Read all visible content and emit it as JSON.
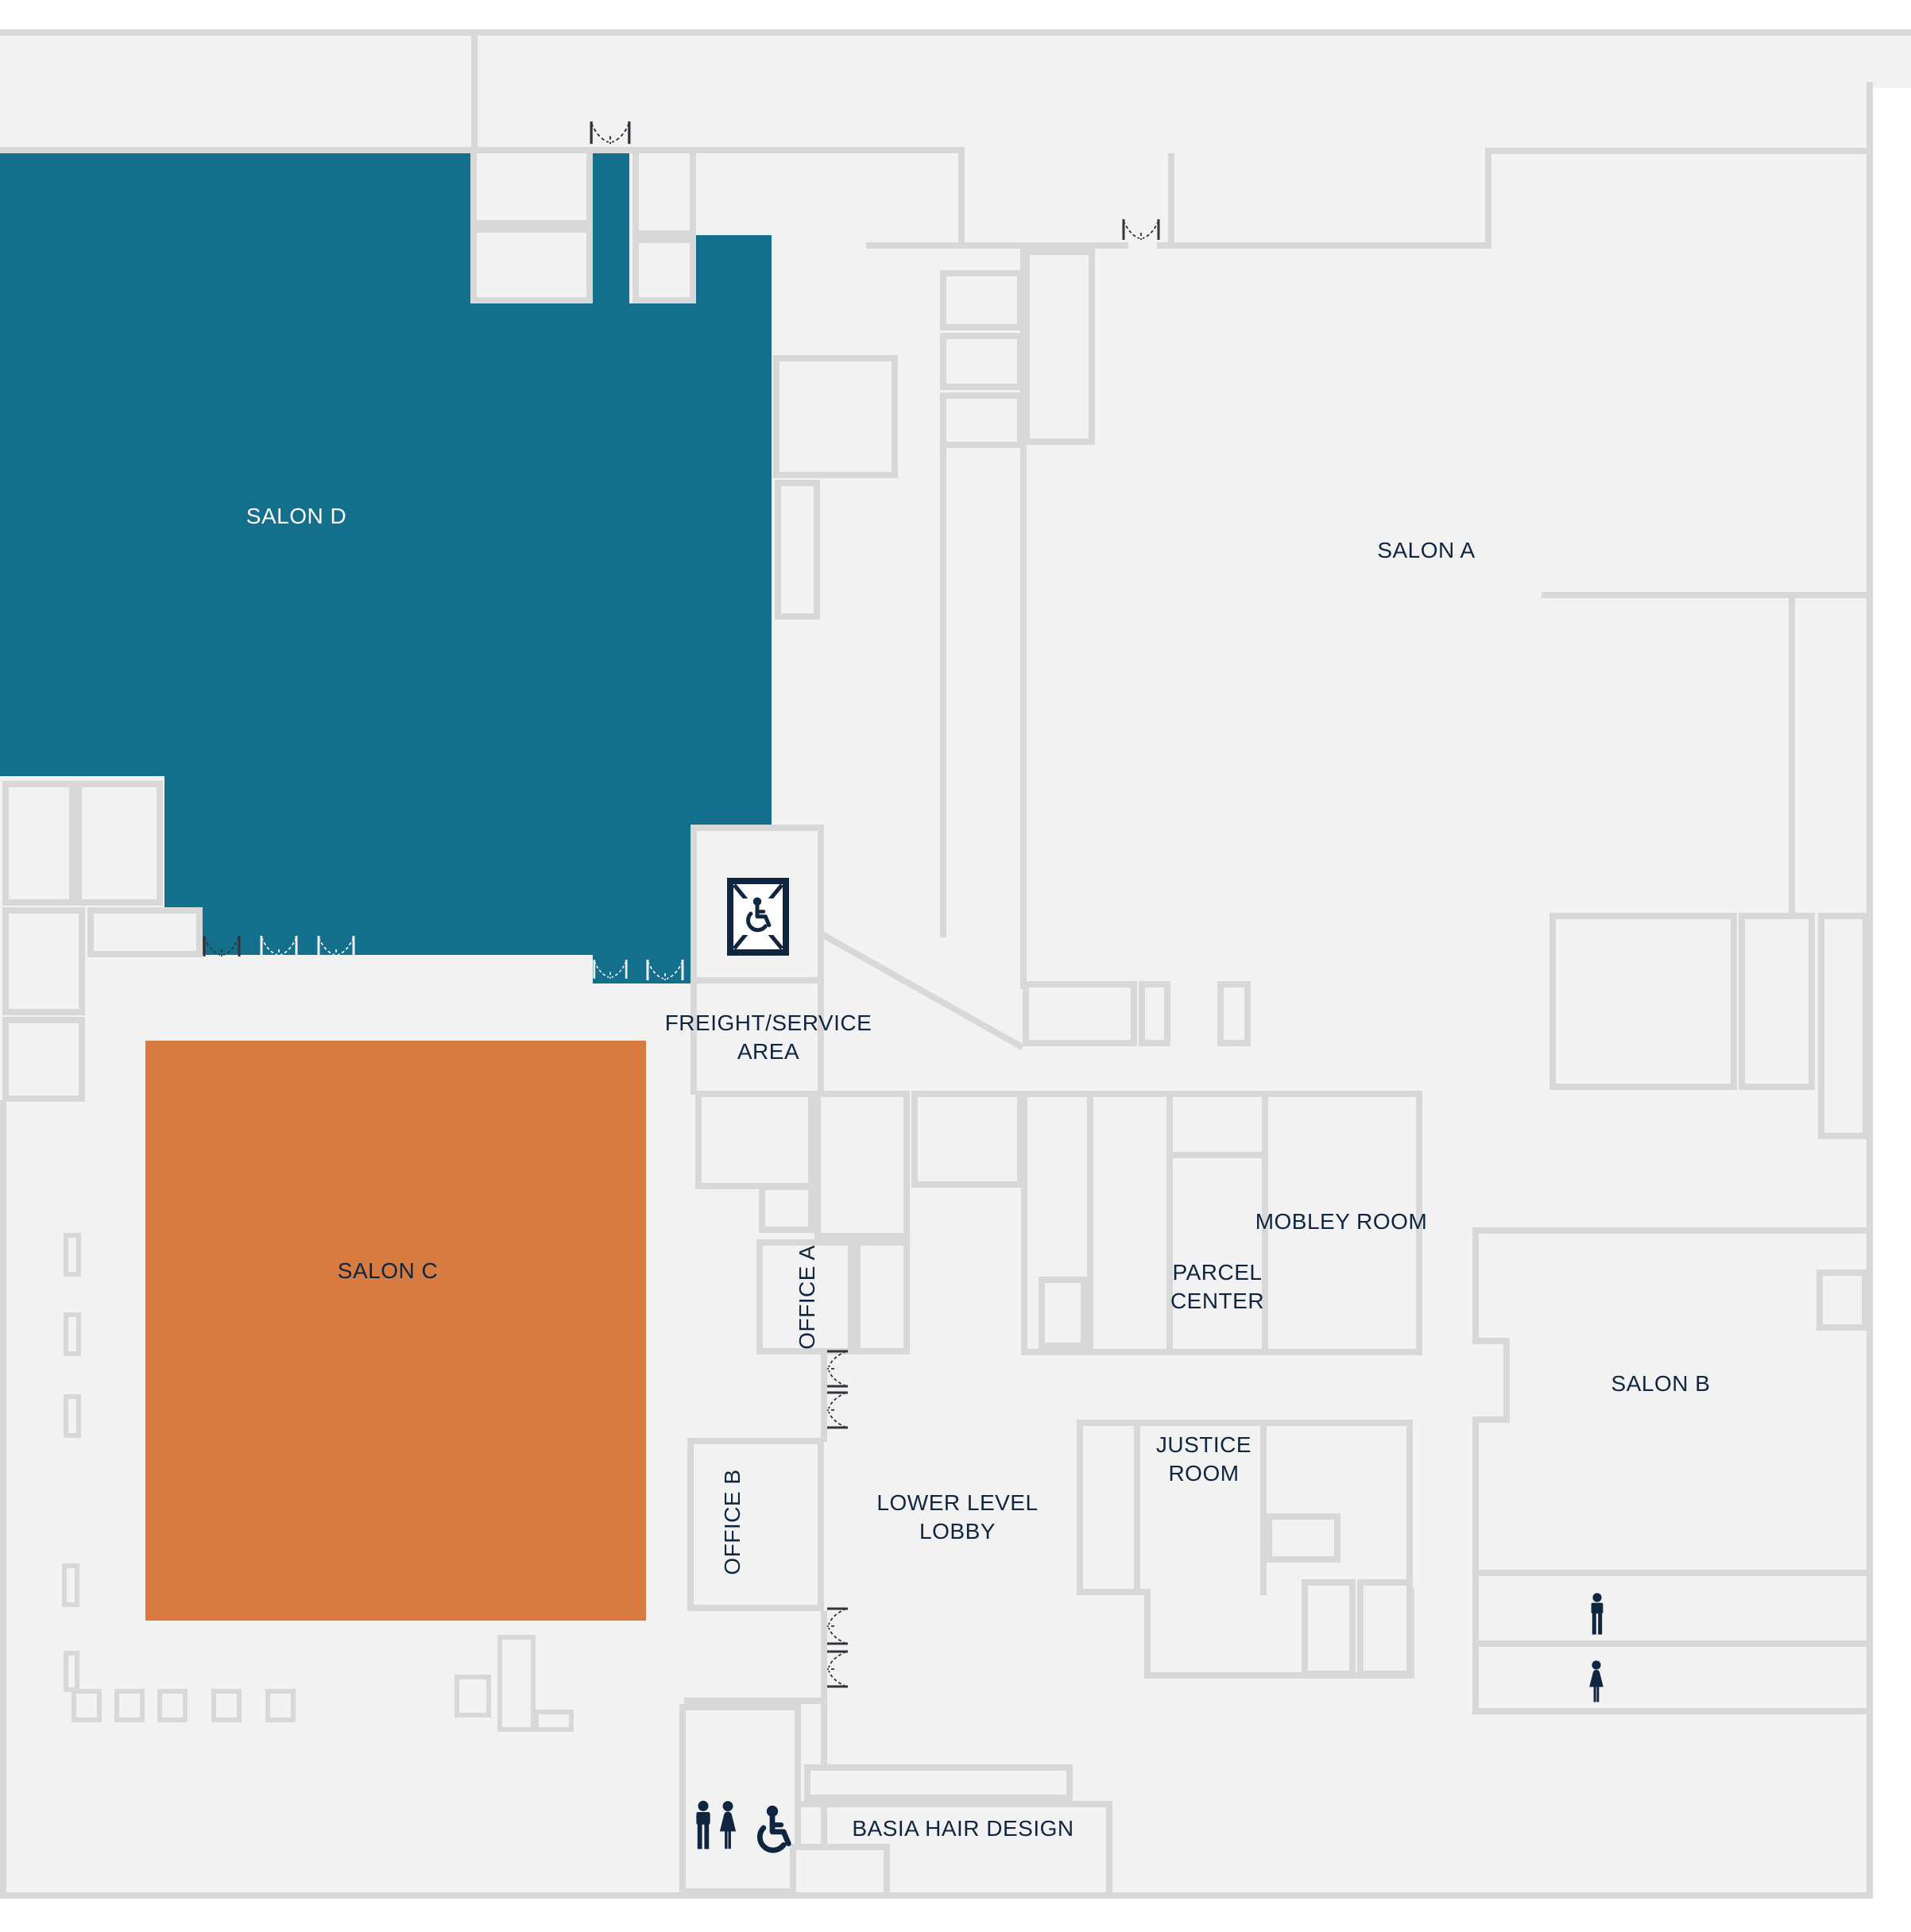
{
  "title": "Lower level floor plan",
  "colors": {
    "teal": "#136F8B",
    "orange": "#D87B40",
    "navy": "#0F2540",
    "wall": "#D8D8D8",
    "floor": "#F2F2F2"
  },
  "rooms": {
    "salon_d": {
      "label": "SALON D"
    },
    "salon_a": {
      "label": "SALON A"
    },
    "salon_b": {
      "label": "SALON B"
    },
    "salon_c": {
      "label": "SALON C"
    },
    "freight_service": {
      "line1": "FREIGHT/SERVICE",
      "line2": "AREA"
    },
    "office_a": {
      "label": "OFFICE A"
    },
    "office_b": {
      "label": "OFFICE B"
    },
    "mobley": {
      "label": "MOBLEY ROOM"
    },
    "parcel": {
      "line1": "PARCEL",
      "line2": "CENTER"
    },
    "justice": {
      "line1": "JUSTICE",
      "line2": "ROOM"
    },
    "lobby": {
      "line1": "LOWER LEVEL",
      "line2": "LOBBY"
    },
    "basia": {
      "label": "BASIA HAIR DESIGN"
    }
  },
  "icons": {
    "freight_elevator": "accessible-freight-elevator",
    "mens_restroom": "man",
    "womens_restroom": "woman",
    "accessible_restroom": "wheelchair",
    "door_swing": "double-door-swing"
  }
}
